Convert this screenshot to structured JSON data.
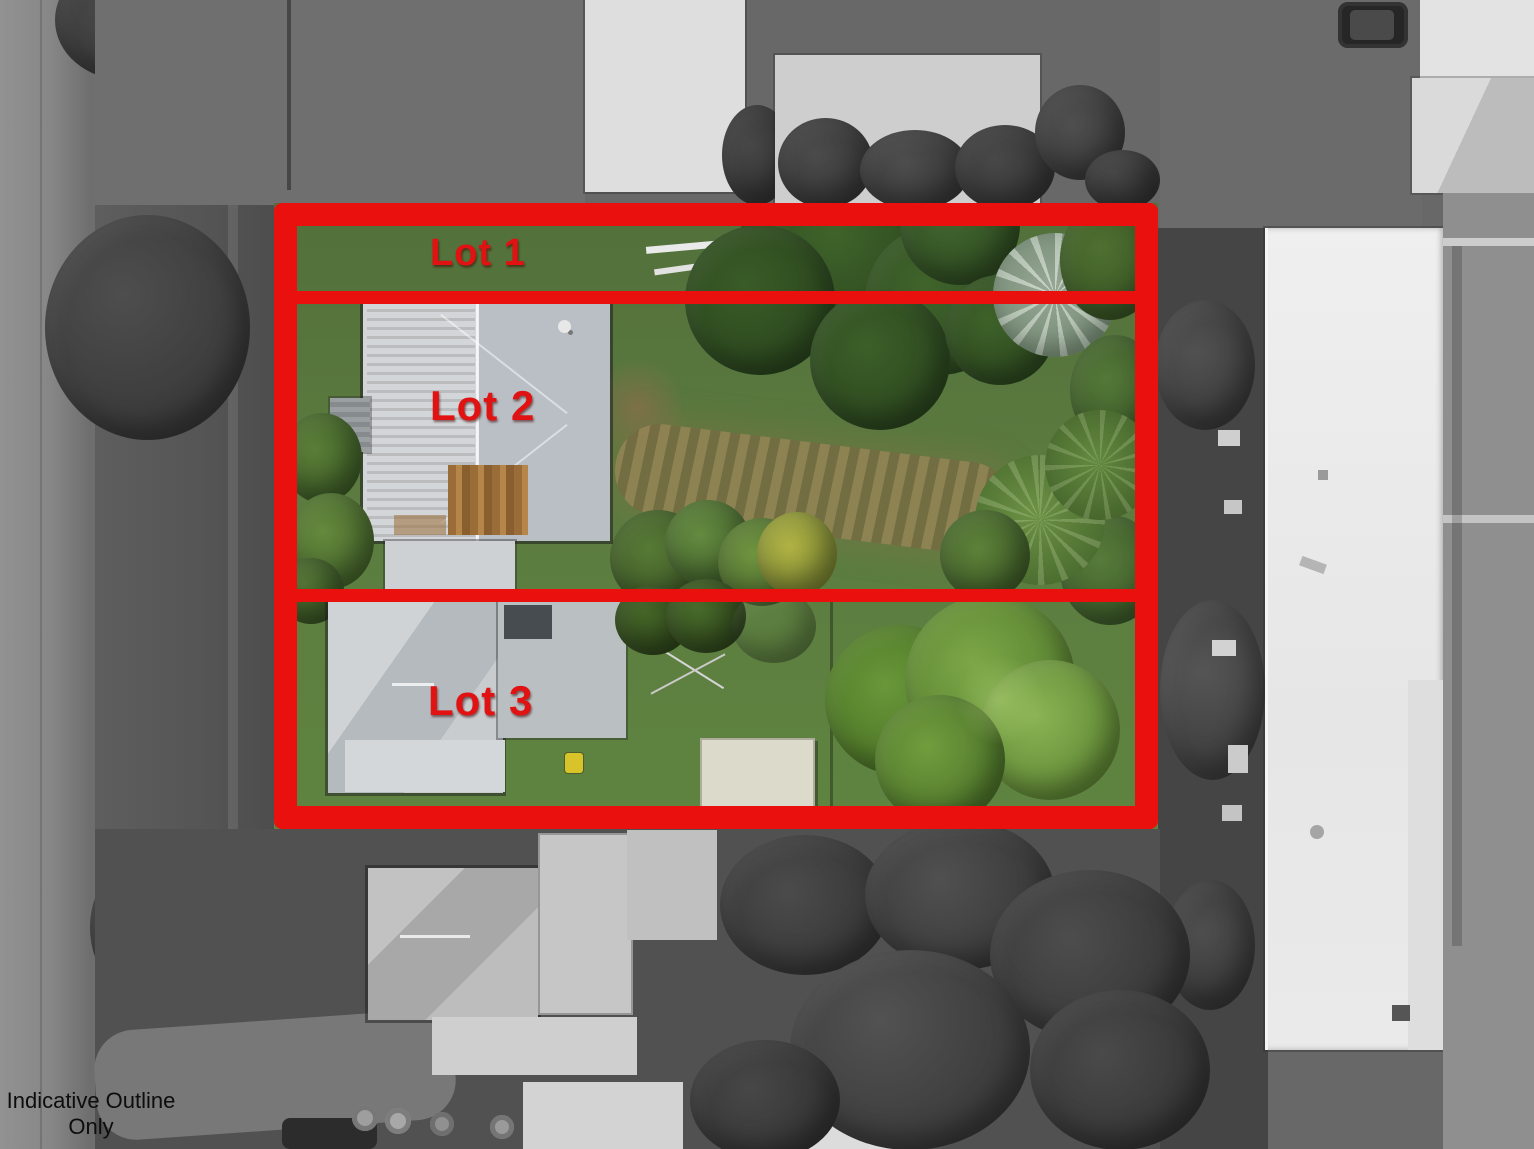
{
  "overlay": {
    "outline_color": "#ea100e",
    "label_color": "#e01212",
    "lots": [
      {
        "label": "Lot 1"
      },
      {
        "label": "Lot 2"
      },
      {
        "label": "Lot 3"
      }
    ]
  },
  "disclaimer": {
    "line1": "Indicative Outline",
    "line2": "Only",
    "color": "#0d0d0d"
  },
  "palette": {
    "grass_green": "#5b7b40",
    "dark_tree_green": "#2f4d21",
    "photo_gray": "#686868",
    "roof_gray": "#c6cacd",
    "rust_brown": "#a5783f",
    "yellow_bin": "#d9c32b",
    "silver_palm": "#a7b9a7"
  }
}
